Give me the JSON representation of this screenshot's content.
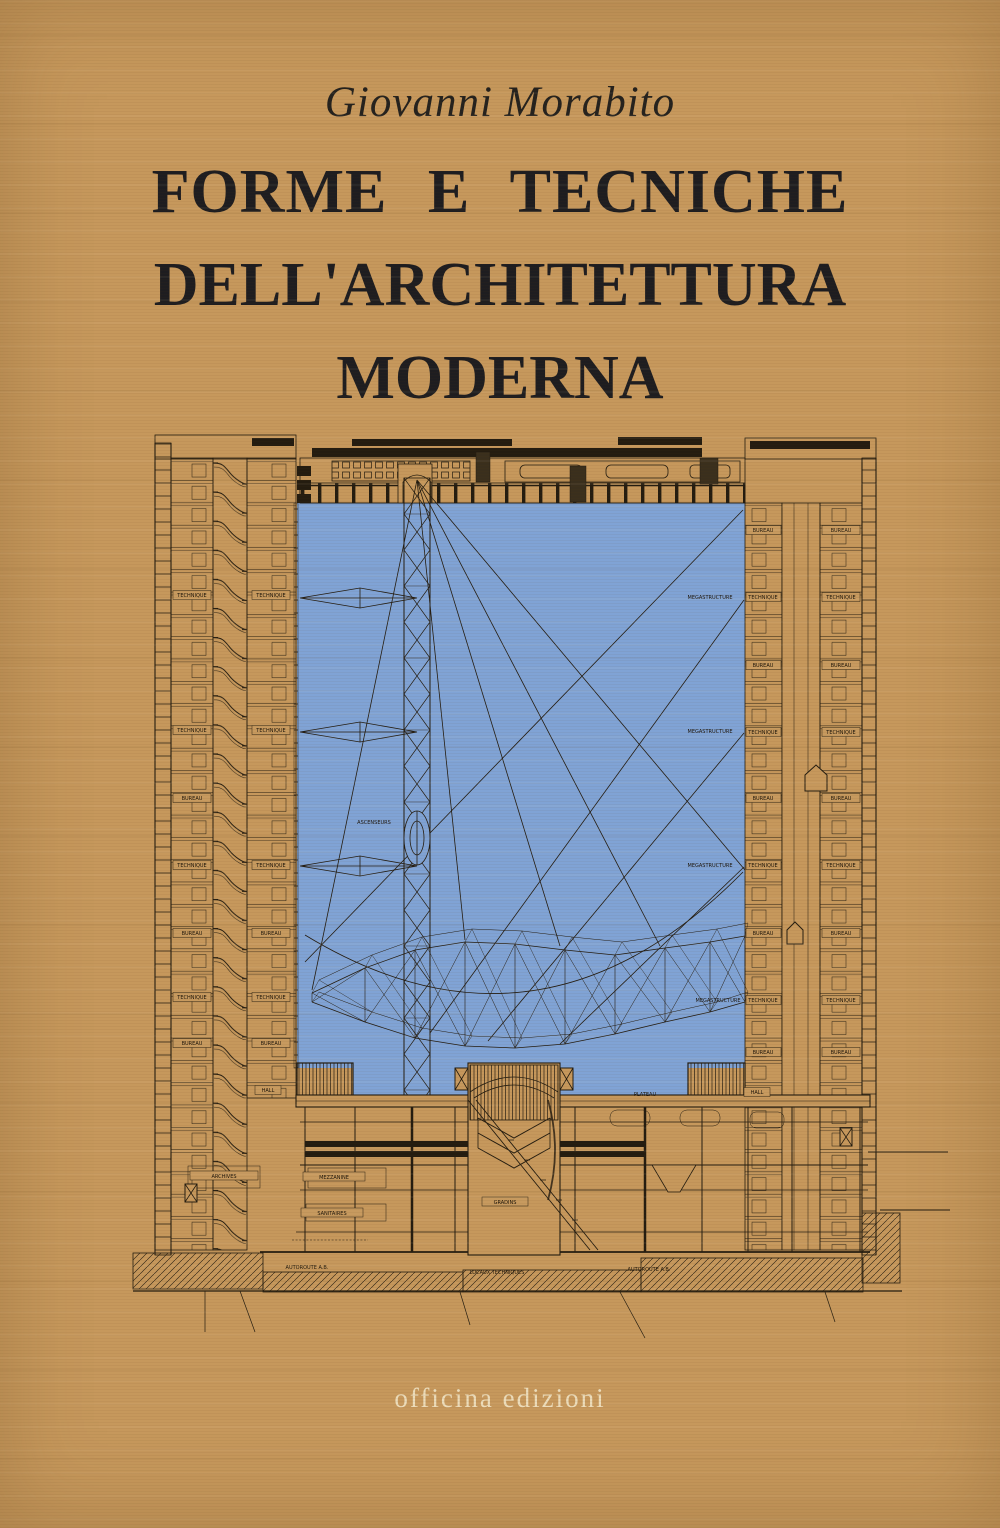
{
  "cover": {
    "author": "Giovanni Morabito",
    "title_line1": "FORME E TECNICHE",
    "title_line2": "DELL'ARCHITETTURA MODERNA",
    "publisher": "officina edizioni"
  },
  "colors": {
    "paper": "#c6985c",
    "void_blue": "#80a3d5",
    "ink": "#241c10",
    "title_ink": "#1e1d20",
    "publisher_cream": "#ecdcba"
  },
  "drawing": {
    "left_tower_rows": [
      {
        "a": "TECHNIQUE",
        "b": "TECHNIQUE"
      },
      {
        "a": "TECHNIQUE",
        "b": "TECHNIQUE"
      },
      {
        "a": "BUREAU",
        "b": ""
      },
      {
        "a": "TECHNIQUE",
        "b": "TECHNIQUE"
      },
      {
        "a": "BUREAU",
        "b": "BUREAU"
      },
      {
        "a": "TECHNIQUE",
        "b": "TECHNIQUE"
      },
      {
        "a": "BUREAU",
        "b": "BUREAU"
      },
      {
        "a": "",
        "b": "HALL"
      }
    ],
    "right_tower_rows": [
      {
        "a": "BUREAU",
        "b": "BUREAU"
      },
      {
        "a": "TECHNIQUE",
        "b": "TECHNIQUE"
      },
      {
        "a": "BUREAU",
        "b": "BUREAU"
      },
      {
        "a": "TECHNIQUE",
        "b": "TECHNIQUE"
      },
      {
        "a": "BUREAU",
        "b": "BUREAU"
      },
      {
        "a": "TECHNIQUE",
        "b": "TECHNIQUE"
      },
      {
        "a": "BUREAU",
        "b": "BUREAU"
      },
      {
        "a": "TECHNIQUE",
        "b": "TECHNIQUE"
      },
      {
        "a": "BUREAU",
        "b": "BUREAU"
      },
      {
        "a": "HALL",
        "b": ""
      }
    ],
    "megastructure_labels": [
      "MEGASTRUCTURE",
      "MEGASTRUCTURE",
      "MEGASTRUCTURE",
      "MEGASTRUCTURE"
    ],
    "elevator_label": "ASCENSEURS",
    "bottom_labels": {
      "plateau": "PLATEAU",
      "archives": "ARCHIVES",
      "mezzanine": "MEZZANINE",
      "sanitaires": "SANITAIRES",
      "gradins": "GRADINS",
      "autoroute_left": "AUTOROUTE  A.B.",
      "locaux": "LOCAUX  TECHNIQUES",
      "autoroute_right": "AUTOROUTE  A.B."
    }
  }
}
